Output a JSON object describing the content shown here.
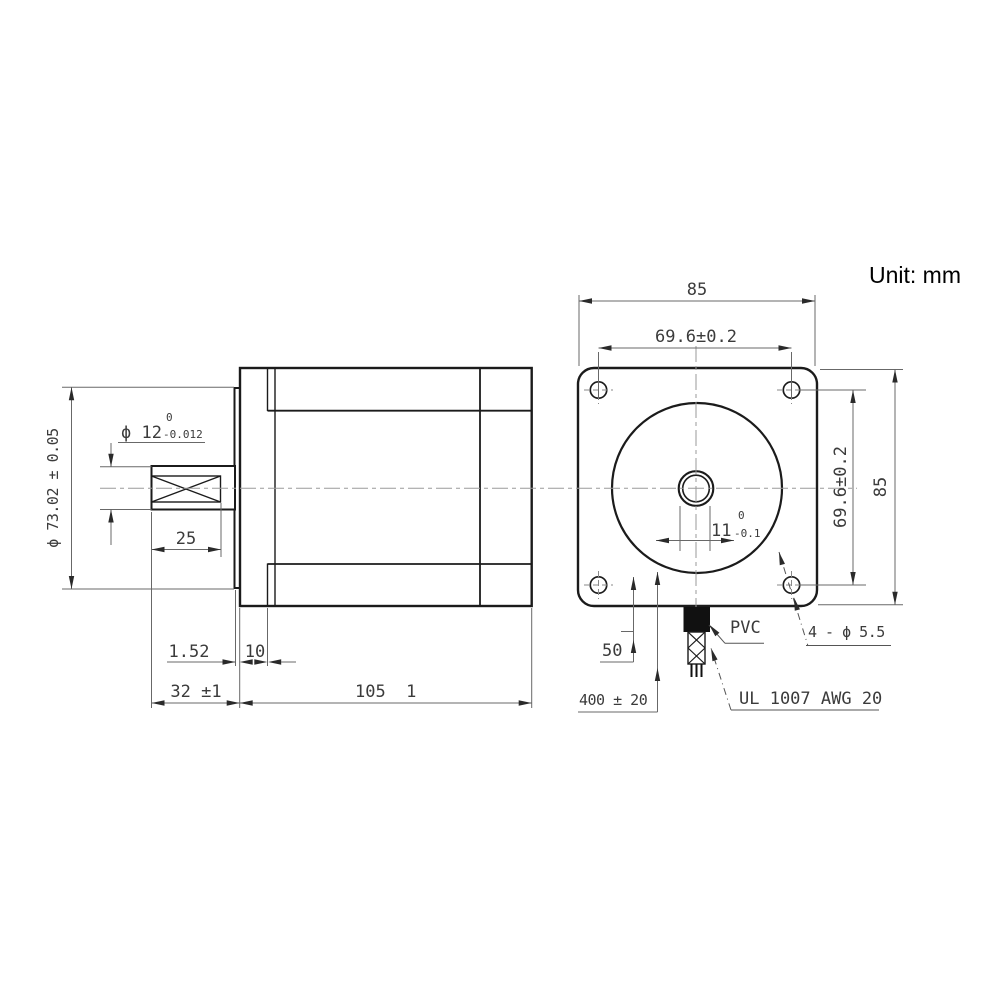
{
  "unit_label": "Unit: mm",
  "dims": {
    "front_width": "85",
    "front_hole_spacing_top": "69.6±0.2",
    "front_hole_spacing_right": "69.6±0.2",
    "front_height": "85",
    "shaft_flat_width": "11",
    "shaft_flat_sup": "0",
    "shaft_flat_sub": "-0.1",
    "mount_holes": "4 - ϕ 5.5",
    "shaft_dia": "ϕ 12",
    "shaft_dia_sup": "0",
    "shaft_dia_sub": "-0.012",
    "flange_dia": "ϕ 73.02 ± 0.05",
    "shaft_length": "25",
    "pilot_depth": "1.52",
    "front_cap_depth": "10",
    "shaft_total": "32 ±1",
    "body_length": "105  1",
    "lead_free_length": "50",
    "cable_length": "400 ± 20"
  },
  "labels": {
    "pvc": "PVC",
    "wire_spec": "UL 1007 AWG 20"
  }
}
